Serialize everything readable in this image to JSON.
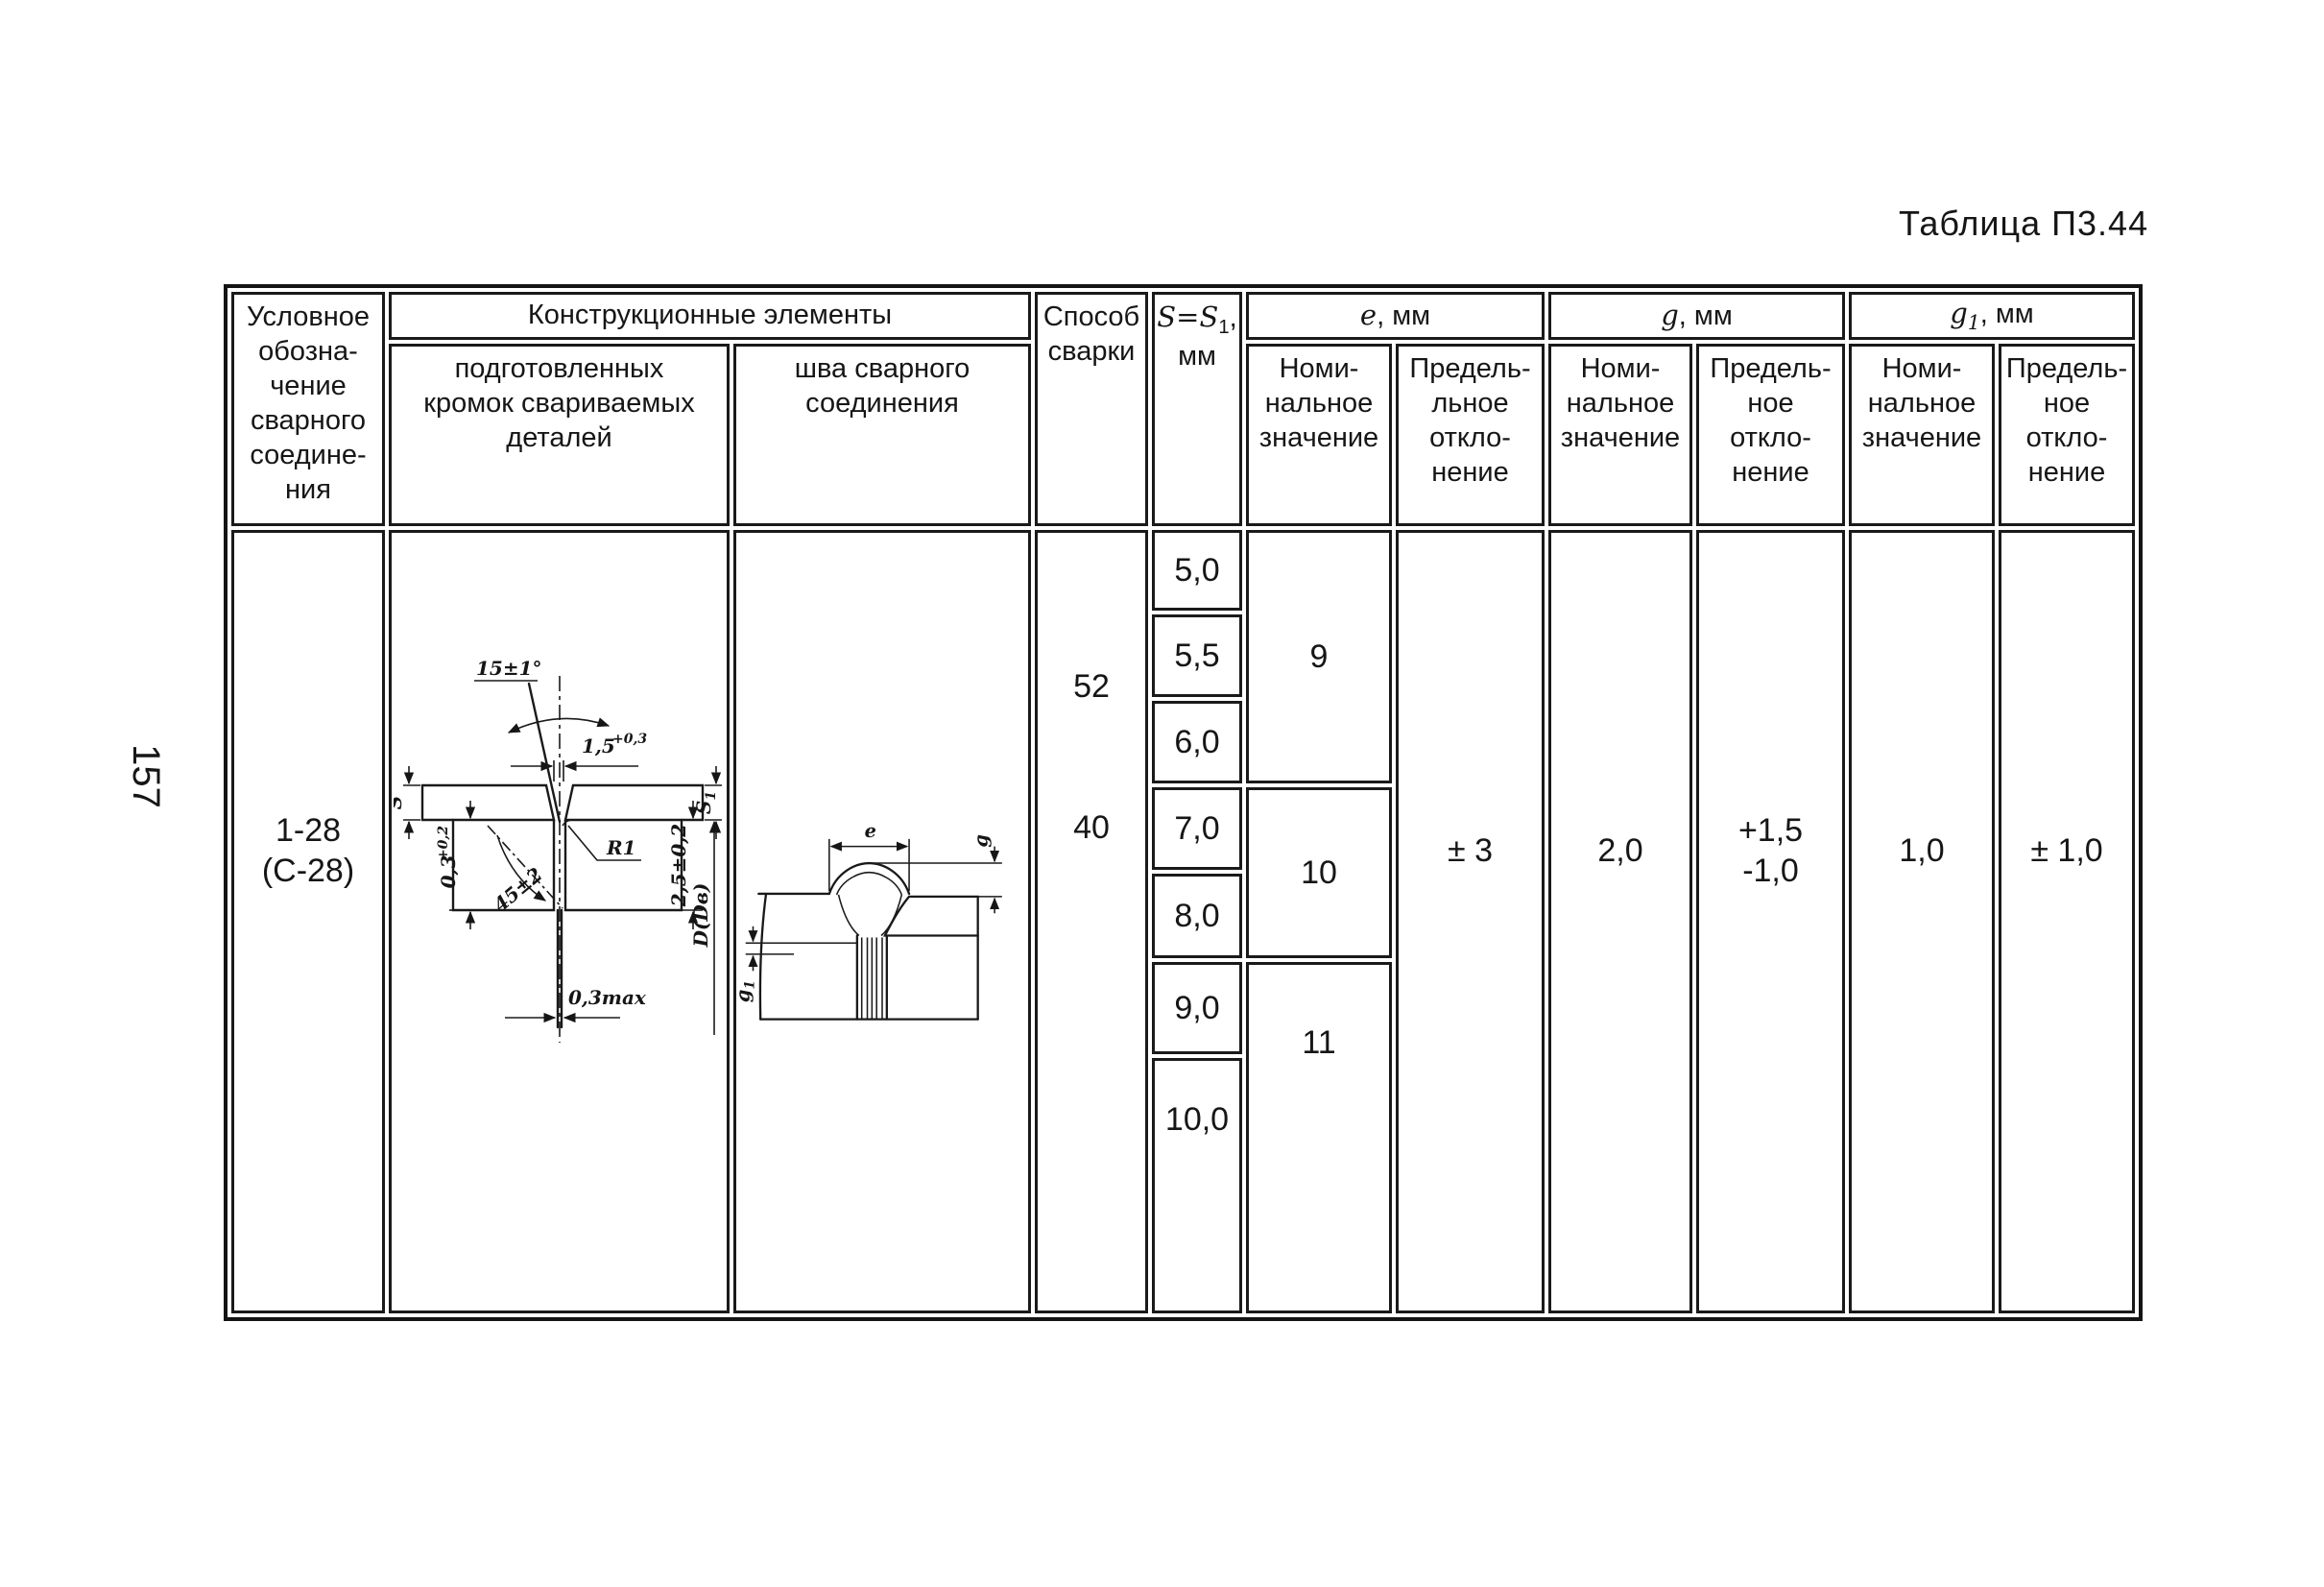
{
  "page": {
    "title": "Таблица П3.44",
    "page_number": "157"
  },
  "header": {
    "symbol": "Условное\nобозна-\nчение\nсварного\nсоедине-\nния",
    "constr": "Конструкционные элементы",
    "prep": "подготовленных\nкромок свариваемых\nдеталей",
    "seam": "шва сварного\nсоединения",
    "method": "Способ\nсварки",
    "s_base": "S=S",
    "s_sub": "1",
    "s_tail": ",",
    "s_unit": "мм",
    "e_sym": "e",
    "e_unit": ", мм",
    "g_sym": "g",
    "g_unit": ", мм",
    "g1_sym": "g",
    "g1_sub": "1",
    "g1_unit": ", мм",
    "nominal": "Номи-\nнальное\nзначение",
    "e_deviation": "Предель-\nльное\nоткло-\nнение",
    "deviation": "Предель-\nное\nоткло-\nнение"
  },
  "row": {
    "joint": "1-28\n(С-28)",
    "methods": [
      "52",
      "40"
    ],
    "s_values": [
      "5,0",
      "5,5",
      "6,0",
      "7,0",
      "8,0",
      "9,0",
      "10,0"
    ],
    "e_nominal": [
      "9",
      "10",
      "11"
    ],
    "e_dev": "± 3",
    "g_nom": "2,0",
    "g_dev": "+1,5\n-1,0",
    "g1_nom": "1,0",
    "g1_dev": "± 1,0"
  },
  "d1": {
    "angle_top": "15±1°",
    "gap_base": "1,5",
    "gap_tol": "+0,3",
    "s": "S",
    "s1_base": "S",
    "s1_sub": "1",
    "step_base": "0,3",
    "step_tol": "+0,2",
    "angle_root": "45±2",
    "radius": "R1",
    "root_gap": "0,3max",
    "lip": "2,5±0,2",
    "dia": "D(Dв)"
  },
  "d2": {
    "e": "e",
    "g": "g",
    "g1_base": "g",
    "g1_sub": "1"
  }
}
